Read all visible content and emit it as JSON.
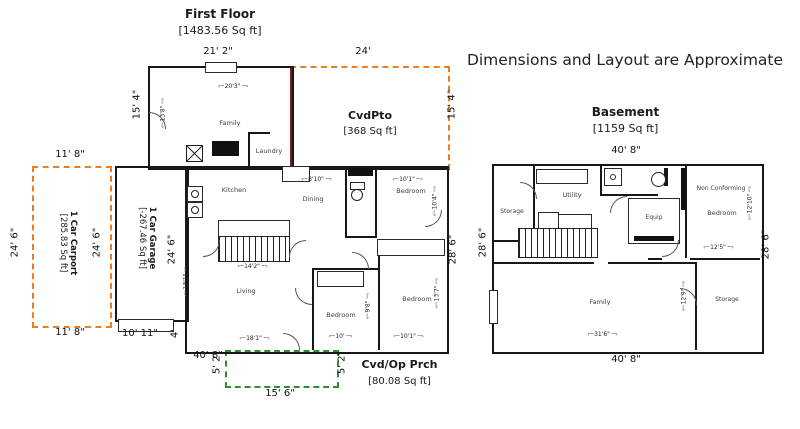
{
  "annotation": "Dimensions and Layout are Approximate",
  "colors": {
    "carport_outline": "#ee7d1e",
    "porch_outline": "#2e8f2e",
    "patio_wall": "#7b1f1f"
  },
  "first_floor": {
    "title": "First Floor",
    "area": "[1483.56 Sq ft]",
    "cvdpto_title": "CvdPto",
    "cvdpto_area": "[368 Sq ft]",
    "porch_title": "Cvd/Op Prch",
    "porch_area": "[80.08 Sq ft]",
    "carport_title": "1 Car Carport",
    "carport_area": "[285.83 Sq ft]",
    "garage_title": "1 Car Garage",
    "garage_area": "[-267.46 Sq ft]",
    "rooms": {
      "family": "Family",
      "laundry": "Laundry",
      "kitchen": "Kitchen",
      "dining": "Dining",
      "living": "Living",
      "bedroom_tr": "Bedroom",
      "bedroom_bl": "Bedroom",
      "bedroom_br": "Bedroom"
    },
    "ext_dims": {
      "top_main": "21' 2\"",
      "top_cvdpto": "24'",
      "left_upper": "15' 4\"",
      "right_cvdpto": "15' 4\"",
      "carport_top": "11' 8\"",
      "carport_bottom": "11' 8\"",
      "carport_left": "24' 6\"",
      "carport_inner": "24' 6\"",
      "garage_right": "24' 6\"",
      "driveway": "10' 11\"",
      "stoop": "4'",
      "bottom": "40' 8\"",
      "right_lower": "28' 6\"",
      "porch_left": "5' 2\"",
      "porch_right": "5' 2\"",
      "porch_bottom": "15' 6\""
    },
    "int_dims": {
      "family_w": "20'3\"",
      "family_h": "13'8\"",
      "dining_w": "8'10\"",
      "bedroom_tr_w": "10'1\"",
      "bedroom_tr_h": "10'4\"",
      "kitchen_w": "14'2\"",
      "living_w": "18'1\"",
      "living_h": "13'1\"",
      "bedroom_bl_w": "10'",
      "bedroom_bl_h": "9'8\"",
      "bedroom_br_w": "10'1\"",
      "bedroom_br_h": "13'7\""
    }
  },
  "basement": {
    "title": "Basement",
    "area": "[1159 Sq ft]",
    "rooms": {
      "storage_tl": "Storage",
      "utility": "Utility",
      "equip": "Equip",
      "ncbr_line1": "Non Conforming",
      "ncbr_line2": "Bedroom",
      "family": "Family",
      "storage_br": "Storage"
    },
    "ext_dims": {
      "top": "40' 8\"",
      "bottom": "40' 8\"",
      "left": "28' 6\"",
      "right": "28' 6\""
    },
    "int_dims": {
      "ncbr_w": "12'5\"",
      "ncbr_h": "12'10\"",
      "family_w": "31'6\"",
      "family_h": "12'9\""
    }
  }
}
